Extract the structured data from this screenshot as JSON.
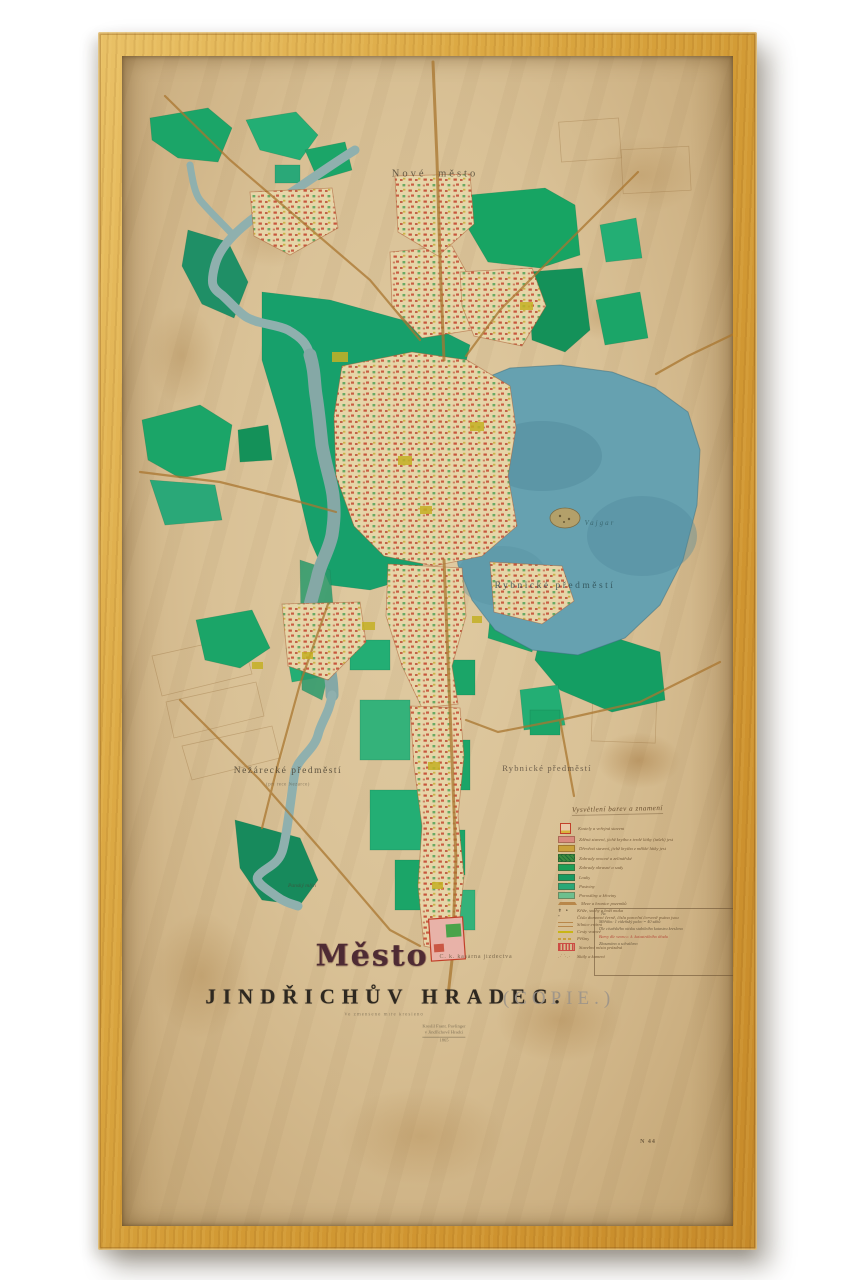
{
  "map": {
    "title_gothic": "Město",
    "title_main": "JINDŘICHŮV HRADEC.",
    "title_copy": "(COPIE.)",
    "subtitle_small": "Ve zmenšené míře kresleno",
    "signature": [
      "Kreslil Frant. Pavlinger",
      "v Jindřichově Hradci",
      "1865"
    ],
    "labels": {
      "nove_mesto": "Nové město",
      "lake_district": "Rybnické předměstí",
      "lake_name": "Vajgar",
      "nezarecke": "Nežárecké předměstí",
      "nezarecke_sub": "(při řece Nežárce)",
      "rybnicke": "Rybnické předměstí",
      "barracks": "C. k. kasárna jízdectva",
      "mill": "Panský mlýn",
      "inventory_mark": "N 44"
    },
    "legend": {
      "heading": "Vysvětlení barev a znamení",
      "rows": [
        {
          "kind": "glyph-building",
          "color": "#e9c9a8",
          "label": "Kostely a veřejná stavení"
        },
        {
          "kind": "swatch",
          "color": "#d98a7e",
          "label": "Zděná stavení, jichž krytba z tvrdé látky (tašek) jest"
        },
        {
          "kind": "swatch",
          "color": "#c9a13b",
          "label": "Dřevěná stavení, jichž krytba z měkké látky jest"
        },
        {
          "kind": "swatch-speckle",
          "color": "#3d8a3f",
          "label": "Zahrady ovocné a zelinářské"
        },
        {
          "kind": "swatch",
          "color": "#1d9e57",
          "label": "Zahrady okrasné a sady"
        },
        {
          "kind": "swatch",
          "color": "#189a62",
          "label": "Louky"
        },
        {
          "kind": "swatch",
          "color": "#2aa878",
          "label": "Pastviny"
        },
        {
          "kind": "swatch",
          "color": "#6cbf8e",
          "label": "Porostliny a křoviny"
        },
        {
          "kind": "wedge",
          "color": "#b8874a",
          "label": "Meze a hranice pozemků"
        },
        {
          "kind": "glyph-dots",
          "color": "#4a3a26",
          "label": "Kříže, sochy a boží muka"
        },
        {
          "kind": "text-only",
          "color": "#6b5030",
          "label": "Čísla domovní černě, čísla parcelní červeně psána jsou"
        },
        {
          "kind": "line-double",
          "color": "#b8874a",
          "label": "Silnice erární"
        },
        {
          "kind": "line",
          "color": "#c9b514",
          "label": "Cesty vozové"
        },
        {
          "kind": "line-dashed",
          "color": "#c9a13b",
          "label": "Pěšiny"
        },
        {
          "kind": "hatch",
          "color": "#cc4c44",
          "label": "Stavební místa prázdná"
        },
        {
          "kind": "scatter",
          "color": "#8a6a3a",
          "label": "Skály a kamení"
        }
      ],
      "note_mark": "№",
      "note_lines": [
        {
          "text": "Měřítko: 1 vídeňský palec = 40 sáhů",
          "color": "#5a4a33"
        },
        {
          "text": "Dle císařského otisku stabilního katastru kreslena",
          "color": "#5a4a33"
        },
        {
          "text": "Barvy dle vzoru c. k. katastrálního úřadu",
          "color": "#b03a2e"
        },
        {
          "text": "Zkoumáno a schváleno",
          "color": "#5a4a33"
        }
      ]
    }
  },
  "colors": {
    "frame_wood": "#d7a345",
    "paper": "#d9c196",
    "river": "#7fa8a4",
    "lake": "#66a1b0",
    "meadow_green": "#1ba568",
    "accent_red": "#c2402a",
    "road_brown": "#a9762f"
  }
}
